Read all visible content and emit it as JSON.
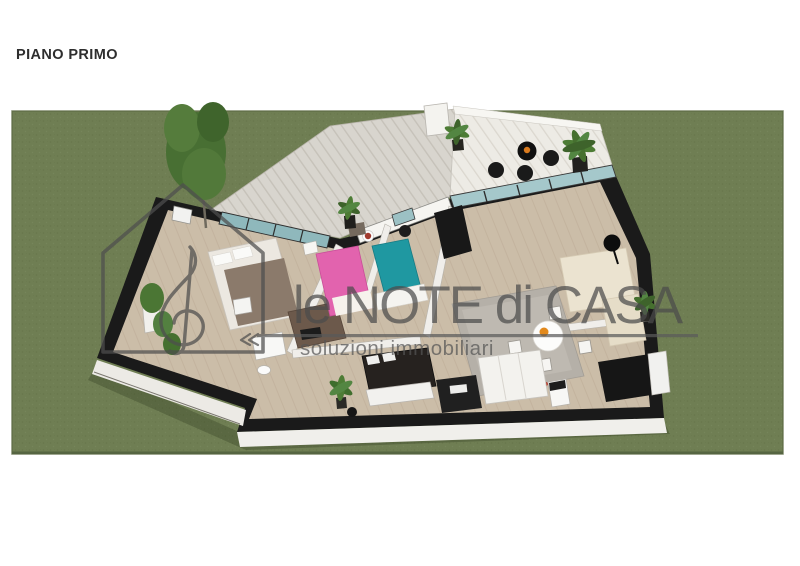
{
  "header": {
    "title": "PIANO PRIMO"
  },
  "watermark": {
    "brand": "le NOTE di CASA",
    "tagline": "soluzioni immobiliari",
    "icon": "house-treble-clef-icon",
    "color": "#585858"
  },
  "scene": {
    "subject": "first-floor apartment 3D plan render on lawn",
    "colors": {
      "lawn": "#6F7E53",
      "walls": "#1A1A1A",
      "floor": "#CBBDA8",
      "deck": "#D8D5CE",
      "terrace_deck": "#EDEBE5",
      "glass": "#9BC0C3",
      "pink_bed": "#E263AE",
      "teal_bed": "#1F98A1",
      "brown_sofa": "#6C594B",
      "cream_sofa": "#EBE3D0",
      "foliage": "#4C7A38"
    }
  }
}
